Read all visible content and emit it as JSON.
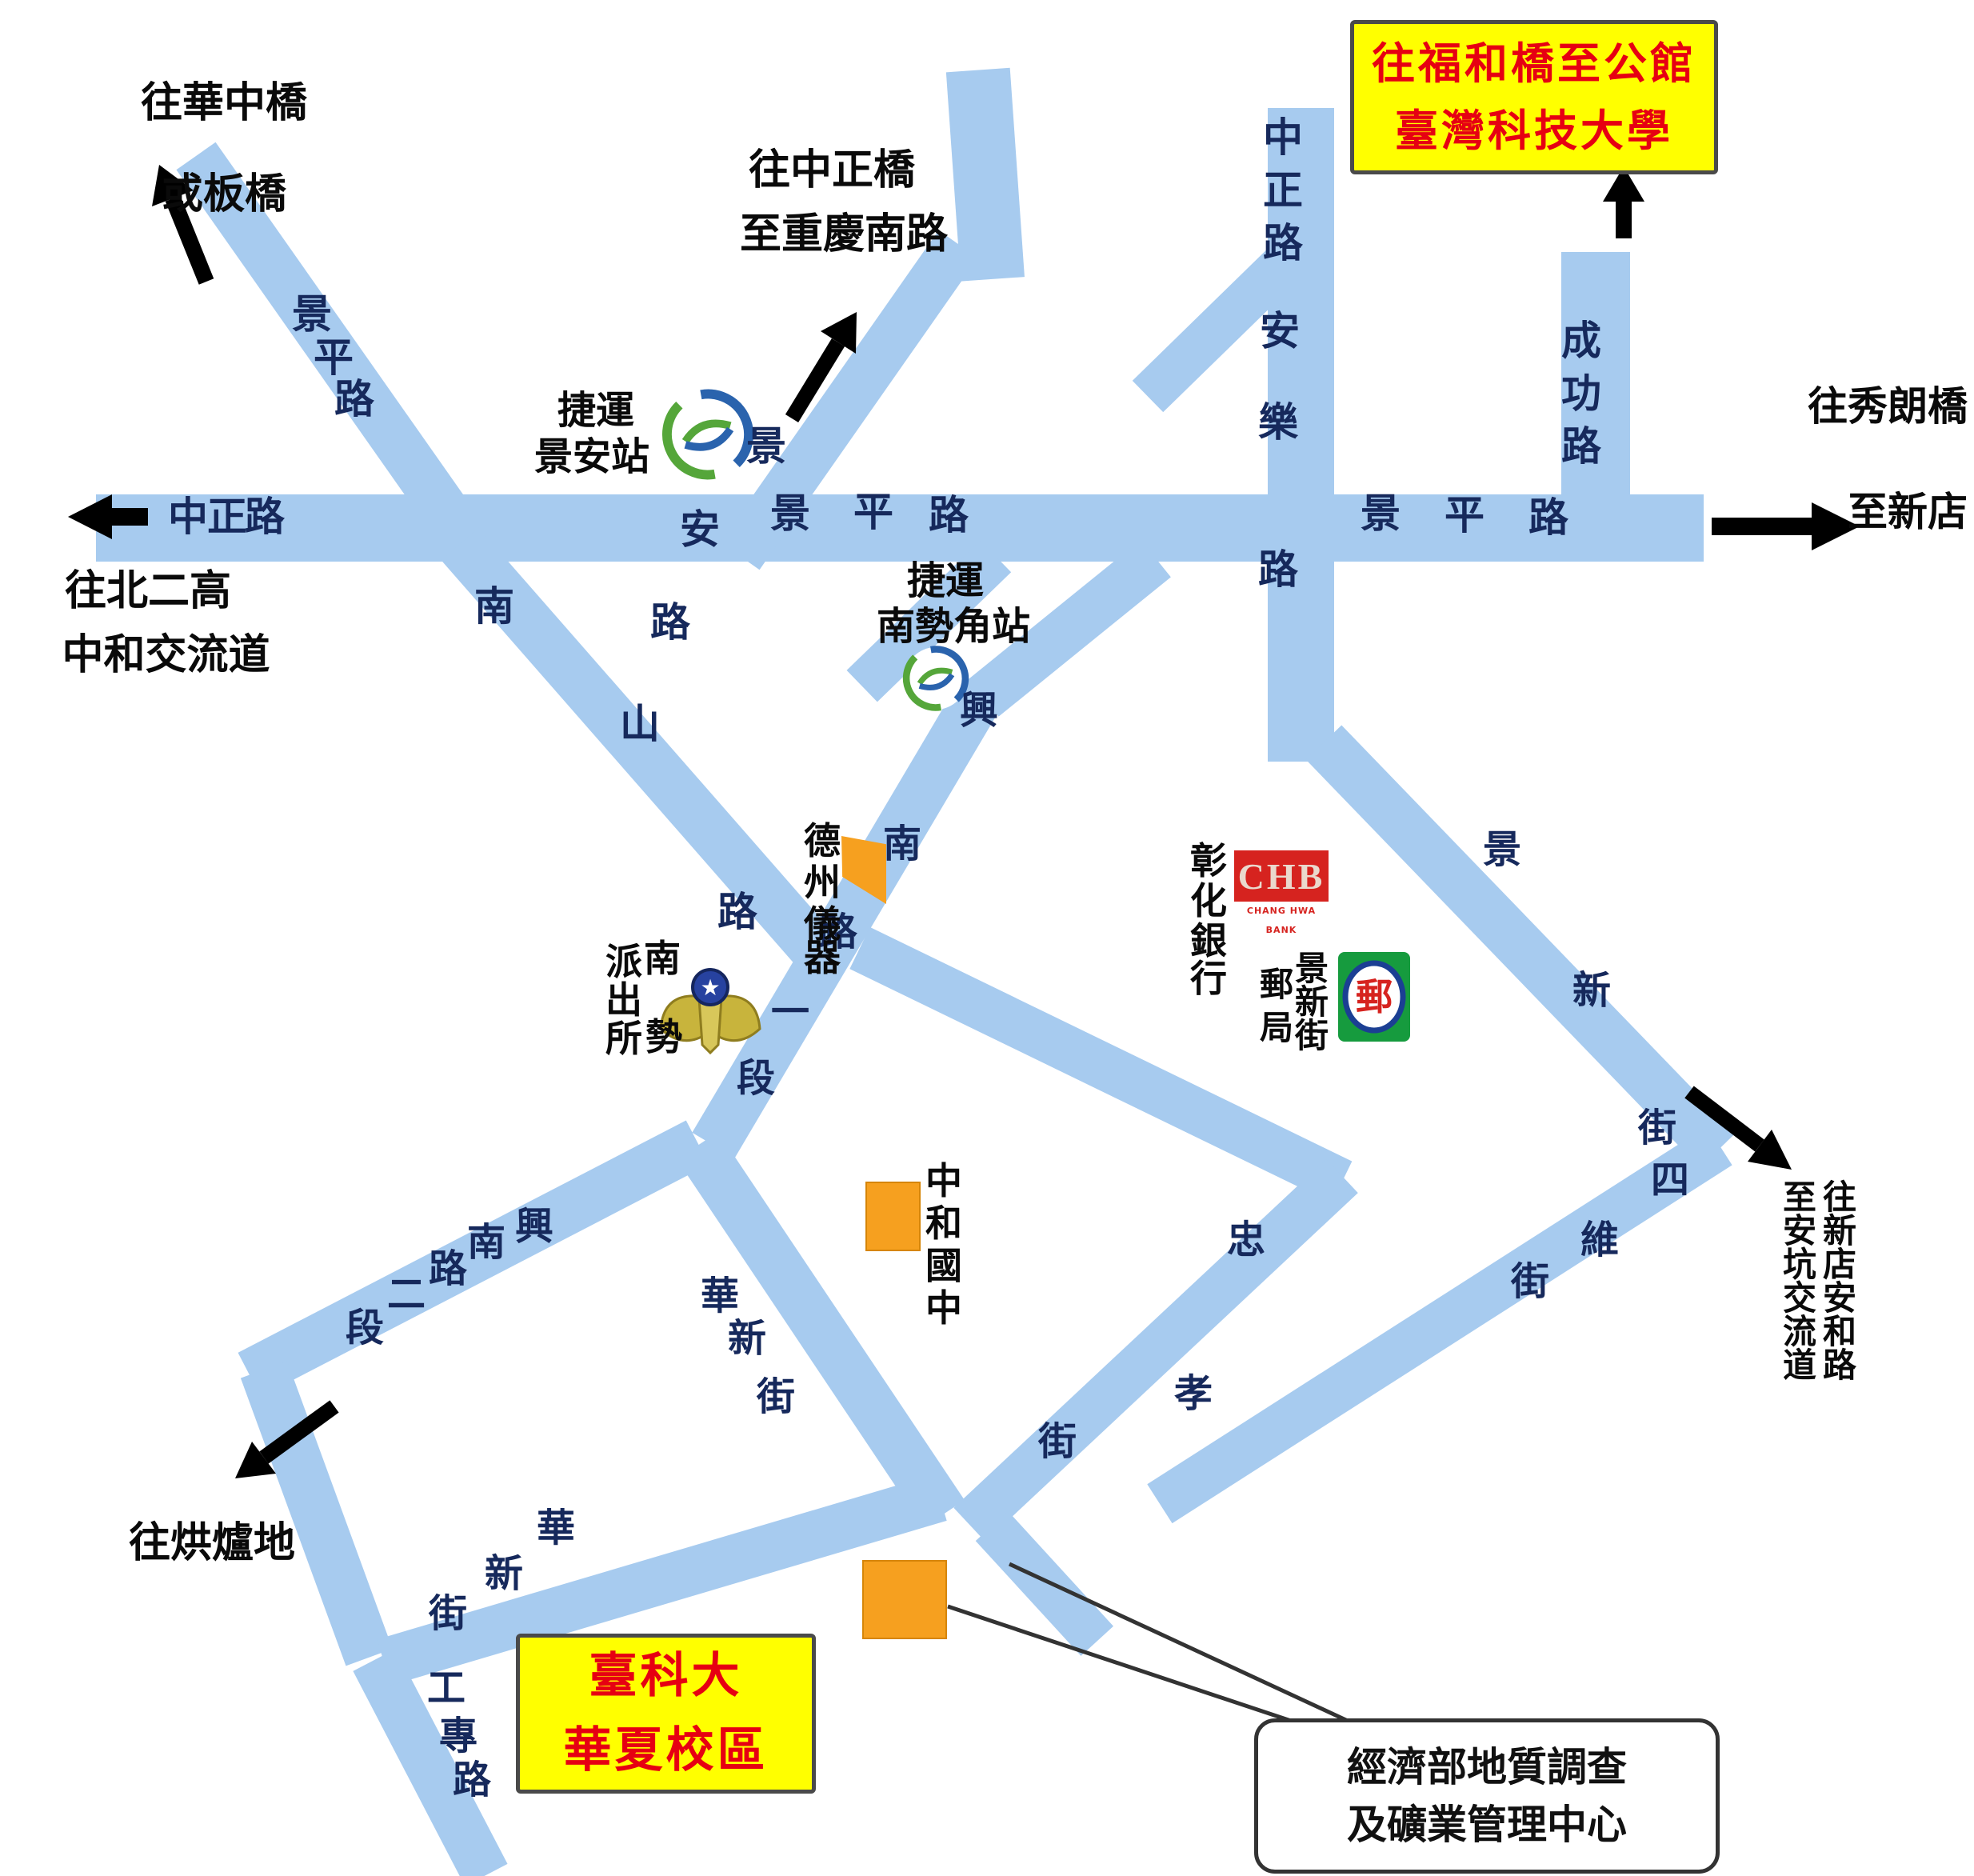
{
  "title_box_top": {
    "line1": "往福和橋至公館",
    "line2": "臺灣科技大學"
  },
  "campus_box": {
    "line1": "臺科大",
    "line2": "華夏校區"
  },
  "callout": {
    "line1": "經濟部地質調查",
    "line2": "及礦業管理中心"
  },
  "destinations": {
    "huazhong_1": "往華中橋",
    "huazhong_2": "或板橋",
    "zhongzheng_bridge_1": "往中正橋",
    "zhongzheng_bridge_2": "至重慶南路",
    "beiergao_1": "往北二高",
    "beiergao_2": "中和交流道",
    "xiulang_1": "往秀朗橋",
    "xiulang_2": "至新店",
    "honglu": "往烘爐地",
    "xindian_col": "往新店安和路",
    "ankeng_col": "至安坑交流道"
  },
  "roads": {
    "jingping_w": "景平路",
    "zhongzheng_left": "中正路",
    "jingping_mid": "景平路",
    "jingping_right": "景平路",
    "jingan": "景安路",
    "zhongzheng_anle": "中正路安樂路",
    "chenggong": "成功路",
    "nanshan": "南山路",
    "xingnan_1": "興南路一段",
    "xingnan_2": "興南路二段",
    "zhongxiao": "忠孝街",
    "siwei": "四維街",
    "jingxin": "景新街",
    "huaxin_n": "華新街",
    "huaxin_w": "華新街",
    "gongzhuan": "工專路"
  },
  "pois": {
    "mrt_jingan_1": "捷運",
    "mrt_jingan_2": "景安站",
    "mrt_nanshijiao_1": "捷運",
    "mrt_nanshijiao_2": "南勢角站",
    "texas": "德州儀器",
    "police_right": "南勢",
    "police_left": "派出所",
    "chb_bank": "彰化銀行",
    "chb_logo_text": "CHB",
    "chb_logo_sub": "CHANG HWA BANK",
    "post_right": "景新街",
    "post_left": "郵局",
    "post_glyph": "郵",
    "zhonghe_school": "中和國中"
  },
  "colors": {
    "road": "#a7cbef",
    "road_text": "#16295c",
    "highlight_bg": "#ffff00",
    "highlight_text": "#e60012",
    "building": "#f6a01f",
    "chb_red": "#d6231f",
    "post_green": "#169b3e",
    "mrt_blue": "#2a63ad",
    "mrt_green": "#55a63a"
  }
}
